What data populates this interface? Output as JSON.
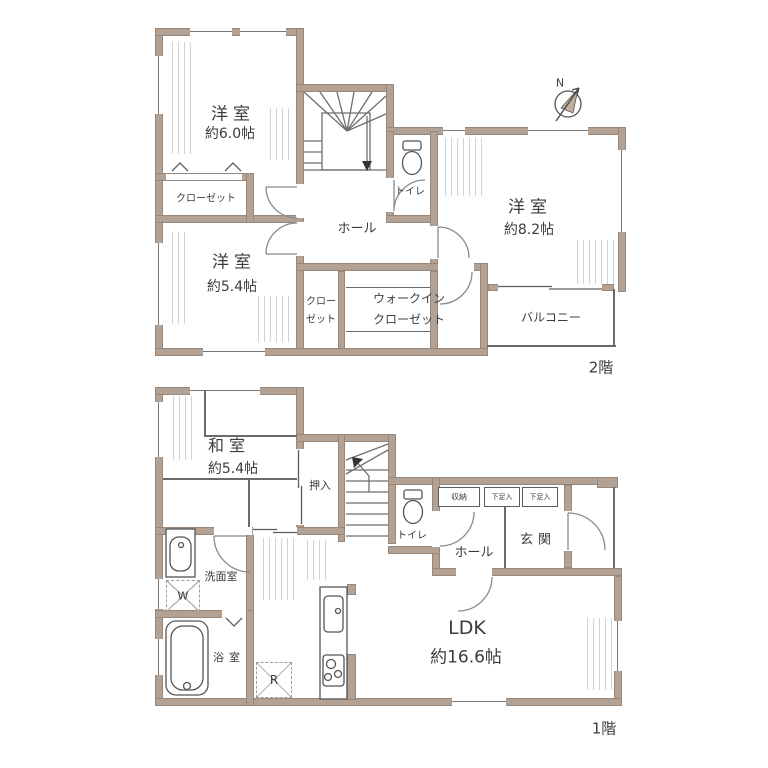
{
  "colors": {
    "wall": "#b3a294",
    "line": "#5d5d5d",
    "needle": "#c2ae9b"
  },
  "floor2": {
    "floor_label": "2階",
    "compass_n": "N",
    "room_west1": {
      "name": "洋室",
      "area": "約6.0帖"
    },
    "room_west2": {
      "name": "洋室",
      "area": "約5.4帖"
    },
    "room_west3": {
      "name": "洋室",
      "area": "約8.2帖"
    },
    "closet1": "クローゼット",
    "closet2": {
      "line1": "クロー",
      "line2": "ゼット"
    },
    "wic": {
      "line1": "ウォークイン",
      "line2": "クローゼット"
    },
    "hall": "ホール",
    "toilet": "トイレ",
    "balcony": "バルコニー"
  },
  "floor1": {
    "floor_label": "1階",
    "washitsu": {
      "name": "和室",
      "area": "約5.4帖"
    },
    "oshiire": "押入",
    "toilet": "トイレ",
    "storage": "収納",
    "shoe1": "下足入",
    "shoe2": "下足入",
    "hall": "ホール",
    "genkan": "玄関",
    "senmen": "洗面室",
    "bath": "浴室",
    "ldk": {
      "name": "LDK",
      "area": "約16.6帖"
    },
    "washer": "W",
    "fridge": "R"
  }
}
